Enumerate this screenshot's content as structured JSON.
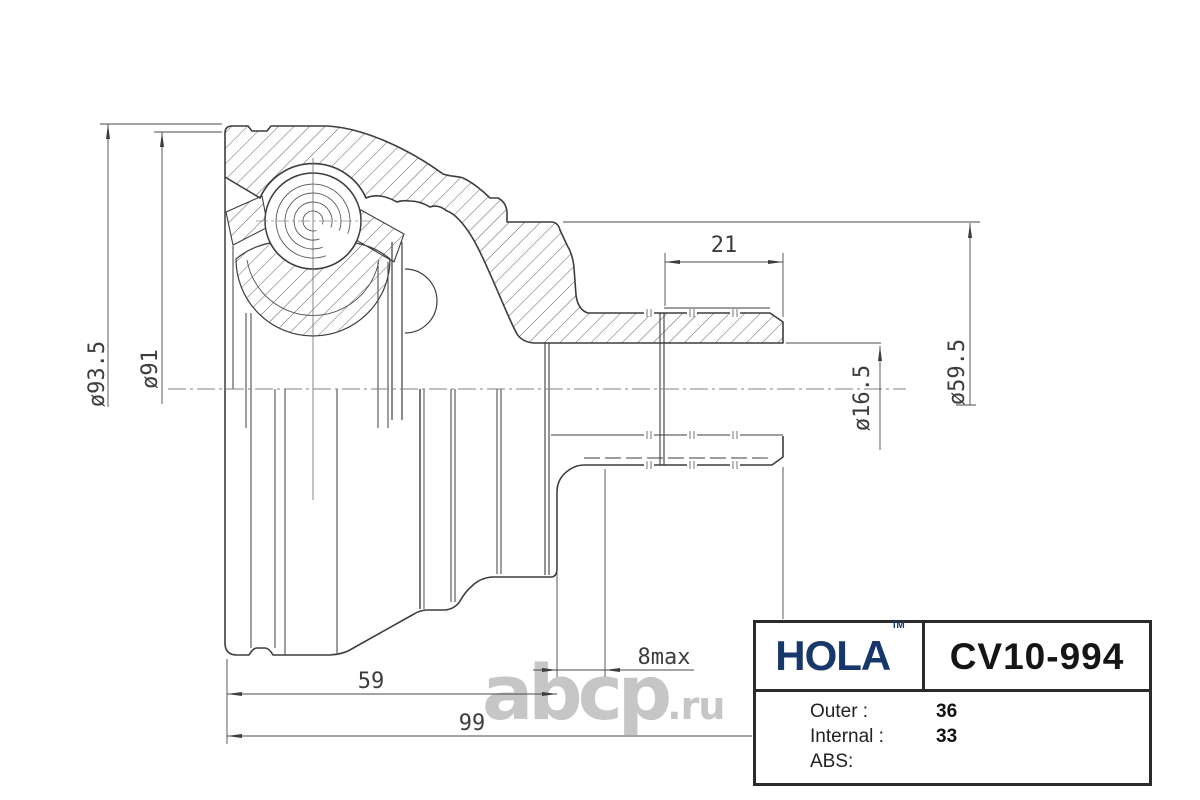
{
  "drawing": {
    "description": "CV joint outer housing cross-section technical drawing",
    "dimensions": {
      "outer_diameter": "ø93.5",
      "rim_diameter": "ø91",
      "spline_length": "21",
      "flange_diameter": "ø59.5",
      "bore_diameter": "ø16.5",
      "thread_max": "8max",
      "body_length": "59",
      "total_length": "99"
    },
    "line_color": "#3d3d3d"
  },
  "watermark": {
    "main": "abcp",
    "suffix": ".ru",
    "color": "#c6c6c6"
  },
  "title_block": {
    "brand": "HOLA",
    "trademark": "TM",
    "part_number": "CV10-994",
    "brand_color": "#17386b",
    "specs": [
      {
        "label": "Outer :",
        "value": "36"
      },
      {
        "label": "Internal :",
        "value": "33"
      },
      {
        "label": "ABS:",
        "value": ""
      }
    ]
  }
}
